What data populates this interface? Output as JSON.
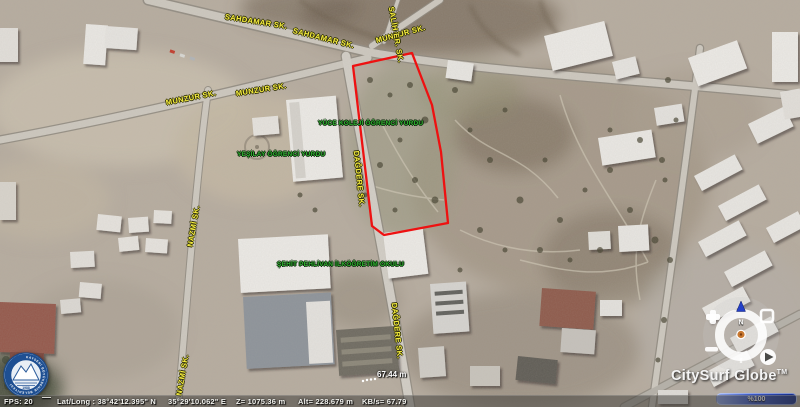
{
  "app": {
    "brand": "CitySurf Globe",
    "brand_tm": "TM"
  },
  "viewport": {
    "streets": {
      "sahdamar_1": "SAHDAMAR SK.",
      "sahdamar_2": "SAHDAMAR SK.",
      "munzur_top": "MUNZUR SK.",
      "salih_er": "SALİH ER. SK.",
      "munzur_left_1": "MUNZUR SK.",
      "munzur_left_2": "MUNZUR SK.",
      "nazmi_1": "NAZMİ SK.",
      "nazmi_2": "NAZMİ SK.",
      "dagdere_1": "DAĞDERE SK.",
      "dagdere_2": "DAĞDERE SK."
    },
    "pois": {
      "dorm_1": "YÜCE KOLEJİ ÖĞRENCİ YURDU",
      "dorm_2": "YEŞİLAY ÖĞRENCİ YURDU",
      "school": "ŞEHİT PEHLİVAN İLKÖĞRETİM OKULU"
    },
    "measurement": {
      "value": "67.44 m"
    }
  },
  "emblem": {
    "ring_text": "KAYSERİ BÜYÜKŞEHİR BELEDİYESİ",
    "year": "1988"
  },
  "compass": {
    "north": "N"
  },
  "progress": {
    "percent": "%100"
  },
  "status": {
    "fps": "FPS: 20",
    "latlong": "Lat/Long : 38°42'12.395\" N",
    "longitude": "35°29'10.062\" E",
    "z": "Z= 1075.36 m",
    "alt": "Alt= 228.679 m",
    "kbps": "KB/s= 67.79"
  },
  "colors": {
    "parcel_outline": "#ee1111",
    "street_label": "#f8ef3e",
    "poi_label": "#2fae2f",
    "progress_bar": "#2a4ab8"
  }
}
